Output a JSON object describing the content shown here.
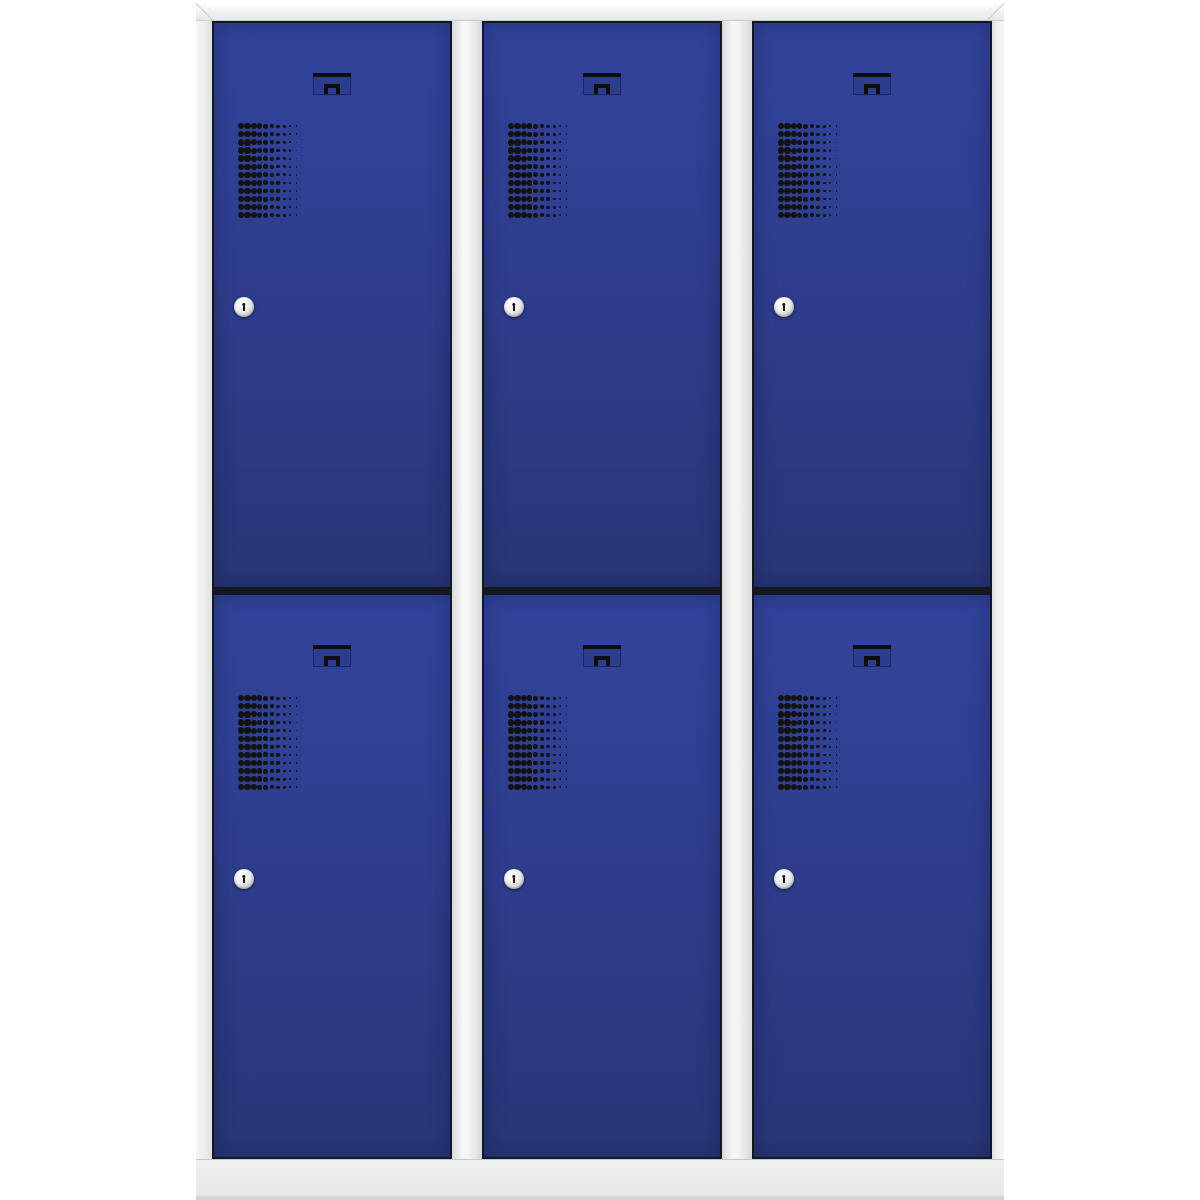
{
  "product": {
    "kind": "cloakroom-locker-cabinet",
    "columns": 3,
    "tiers_per_column": 2,
    "compartments": 6,
    "door_features": [
      "recessed-latch-handle",
      "ventilation-grille",
      "cylinder-lock"
    ]
  },
  "colors": {
    "background": "#ffffff",
    "door_blue": "#2e3e8e",
    "door_blue_light": "#32439b",
    "door_blue_dark": "#283677",
    "frame_grey": "#eceeee",
    "frame_grey_light": "#f8f9f9",
    "frame_grey_dark": "#d9dbdb",
    "plinth_grey": "#e7e9e9",
    "seam_dark": "#17181c",
    "vent_dot": "#121212",
    "keyhole": "#101010"
  },
  "grille": {
    "rows": 12,
    "cols": 10,
    "row_pitch": 8.1,
    "col_pitch": 6.15,
    "dot_sizes": [
      6.4,
      6.4,
      6.0,
      5.5,
      4.9,
      4.2,
      3.4,
      2.8,
      2.2,
      1.8
    ]
  },
  "geometry": {
    "cabinet": {
      "left": 196,
      "top": 4,
      "width": 808,
      "height": 1196
    },
    "top_rail_height": 17,
    "door_top_height": 568,
    "seam_height": 4,
    "divider_width": 30,
    "handle_top_offset": 50,
    "vent_offset": {
      "left": 24,
      "top": 100
    },
    "lock_offset": {
      "left": 20,
      "top": 274
    }
  }
}
